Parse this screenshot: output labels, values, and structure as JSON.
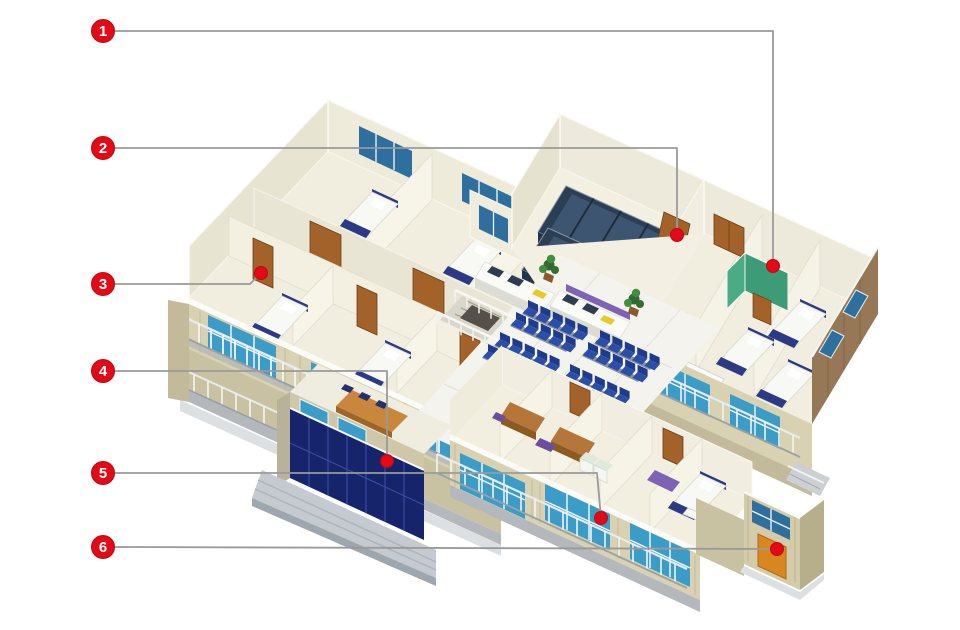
{
  "callouts": [
    {
      "label": "1",
      "badge": {
        "x": 103,
        "y": 31
      },
      "line": [
        [
          115,
          31
        ],
        [
          773,
          31
        ],
        [
          773,
          266
        ]
      ],
      "dot": {
        "x": 773,
        "y": 266
      },
      "target": "green-washroom-cubicle"
    },
    {
      "label": "2",
      "badge": {
        "x": 103,
        "y": 148
      },
      "line": [
        [
          115,
          148
        ],
        [
          677,
          148
        ],
        [
          677,
          235
        ]
      ],
      "dot": {
        "x": 677,
        "y": 235
      },
      "target": "storage-room-door"
    },
    {
      "label": "3",
      "badge": {
        "x": 103,
        "y": 284
      },
      "line": [
        [
          115,
          284
        ],
        [
          250,
          284
        ],
        [
          261,
          273
        ]
      ],
      "dot": {
        "x": 261,
        "y": 273
      },
      "target": "ward-room-door"
    },
    {
      "label": "4",
      "badge": {
        "x": 103,
        "y": 371
      },
      "line": [
        [
          115,
          371
        ],
        [
          387,
          371
        ],
        [
          387,
          461
        ]
      ],
      "dot": {
        "x": 387,
        "y": 461
      },
      "target": "entrance-glass-wall"
    },
    {
      "label": "5",
      "badge": {
        "x": 103,
        "y": 473
      },
      "line": [
        [
          115,
          473
        ],
        [
          597,
          473
        ],
        [
          601,
          518
        ]
      ],
      "dot": {
        "x": 601,
        "y": 518
      },
      "target": "clinic-wing-window"
    },
    {
      "label": "6",
      "badge": {
        "x": 103,
        "y": 547
      },
      "line": [
        [
          115,
          547
        ],
        [
          777,
          549
        ]
      ],
      "dot": {
        "x": 777,
        "y": 549
      },
      "target": "annex-side-door"
    }
  ],
  "marker": {
    "badge_radius": 11.5,
    "dot_radius": 6.5
  },
  "colors": {
    "marker_red": "#e20a16",
    "marker_edge": "#c00812",
    "badge_number": "#ffffff",
    "leader_gray": "#9a9a9a",
    "wall_cream": "#f0ecdc",
    "floor_cream": "#f2eedf",
    "lobby_floor": "#f4f3ee",
    "window_teal": "#3a9cc7",
    "window_steel_blue": "#2e6f9d",
    "entrance_navy": "#16246b",
    "siding_beige": "#d6cfae",
    "exterior_brown": "#967856",
    "door_wood": "#a2622a",
    "door_orange": "#d8861f",
    "cubicle_green": "#3d9b77",
    "chairs_blue": "#2b4ea8",
    "shelving_slate": "#2c3e54",
    "accent_purple": "#7e63b4",
    "table_wood": "#c8873c",
    "plant_green": "#3f8f3f",
    "steps_gray": "#c5cad0"
  }
}
